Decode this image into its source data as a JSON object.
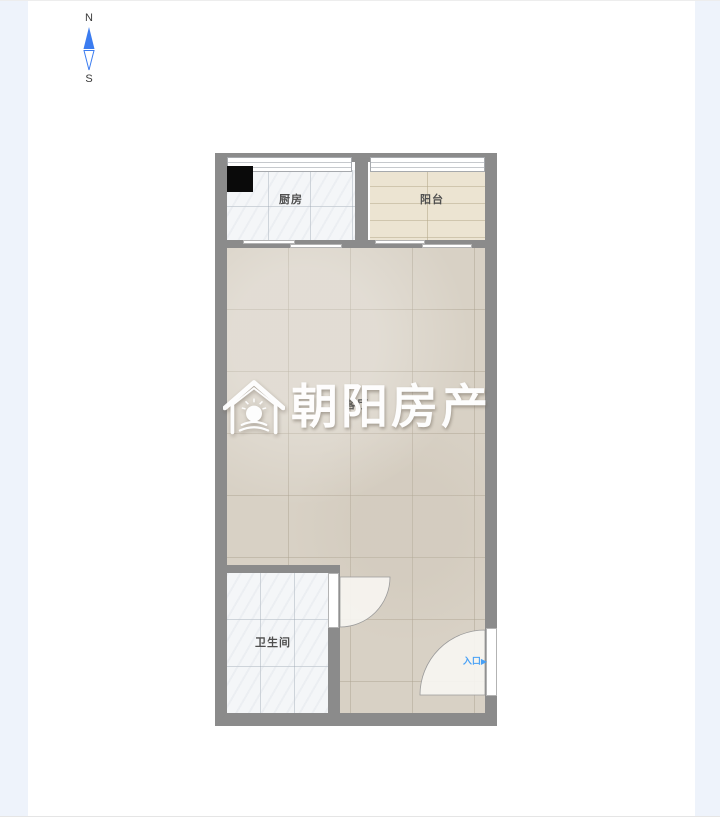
{
  "page": {
    "background_color": "#ffffff",
    "side_strip_color": "#eef3fb"
  },
  "compass": {
    "north_label": "N",
    "south_label": "S",
    "needle_color": "#3b7cf0"
  },
  "watermark": {
    "brand_text": "朝阳房产",
    "logo_icon": "house-sun-logo",
    "color": "#ffffff"
  },
  "floorplan": {
    "wall_color": "#8b8b8b",
    "rooms": {
      "kitchen": {
        "label": "厨房",
        "floor_color": "#f4f6f8",
        "feature": "black-stove-square"
      },
      "balcony": {
        "label": "阳台",
        "floor_color": "#ece4d2"
      },
      "living": {
        "label": "客厅",
        "floor_color": "#d8d1c5"
      },
      "bathroom": {
        "label": "卫生间",
        "floor_color": "#f4f6f8"
      }
    },
    "entrance": {
      "label": "入口",
      "arrow_icon": "▶",
      "color": "#47a0f6"
    },
    "doors": [
      "bathroom-swing-door",
      "entrance-swing-door"
    ],
    "windows": [
      "kitchen-top-window",
      "balcony-top-window",
      "kitchen-sliding-door",
      "balcony-sliding-door"
    ]
  }
}
